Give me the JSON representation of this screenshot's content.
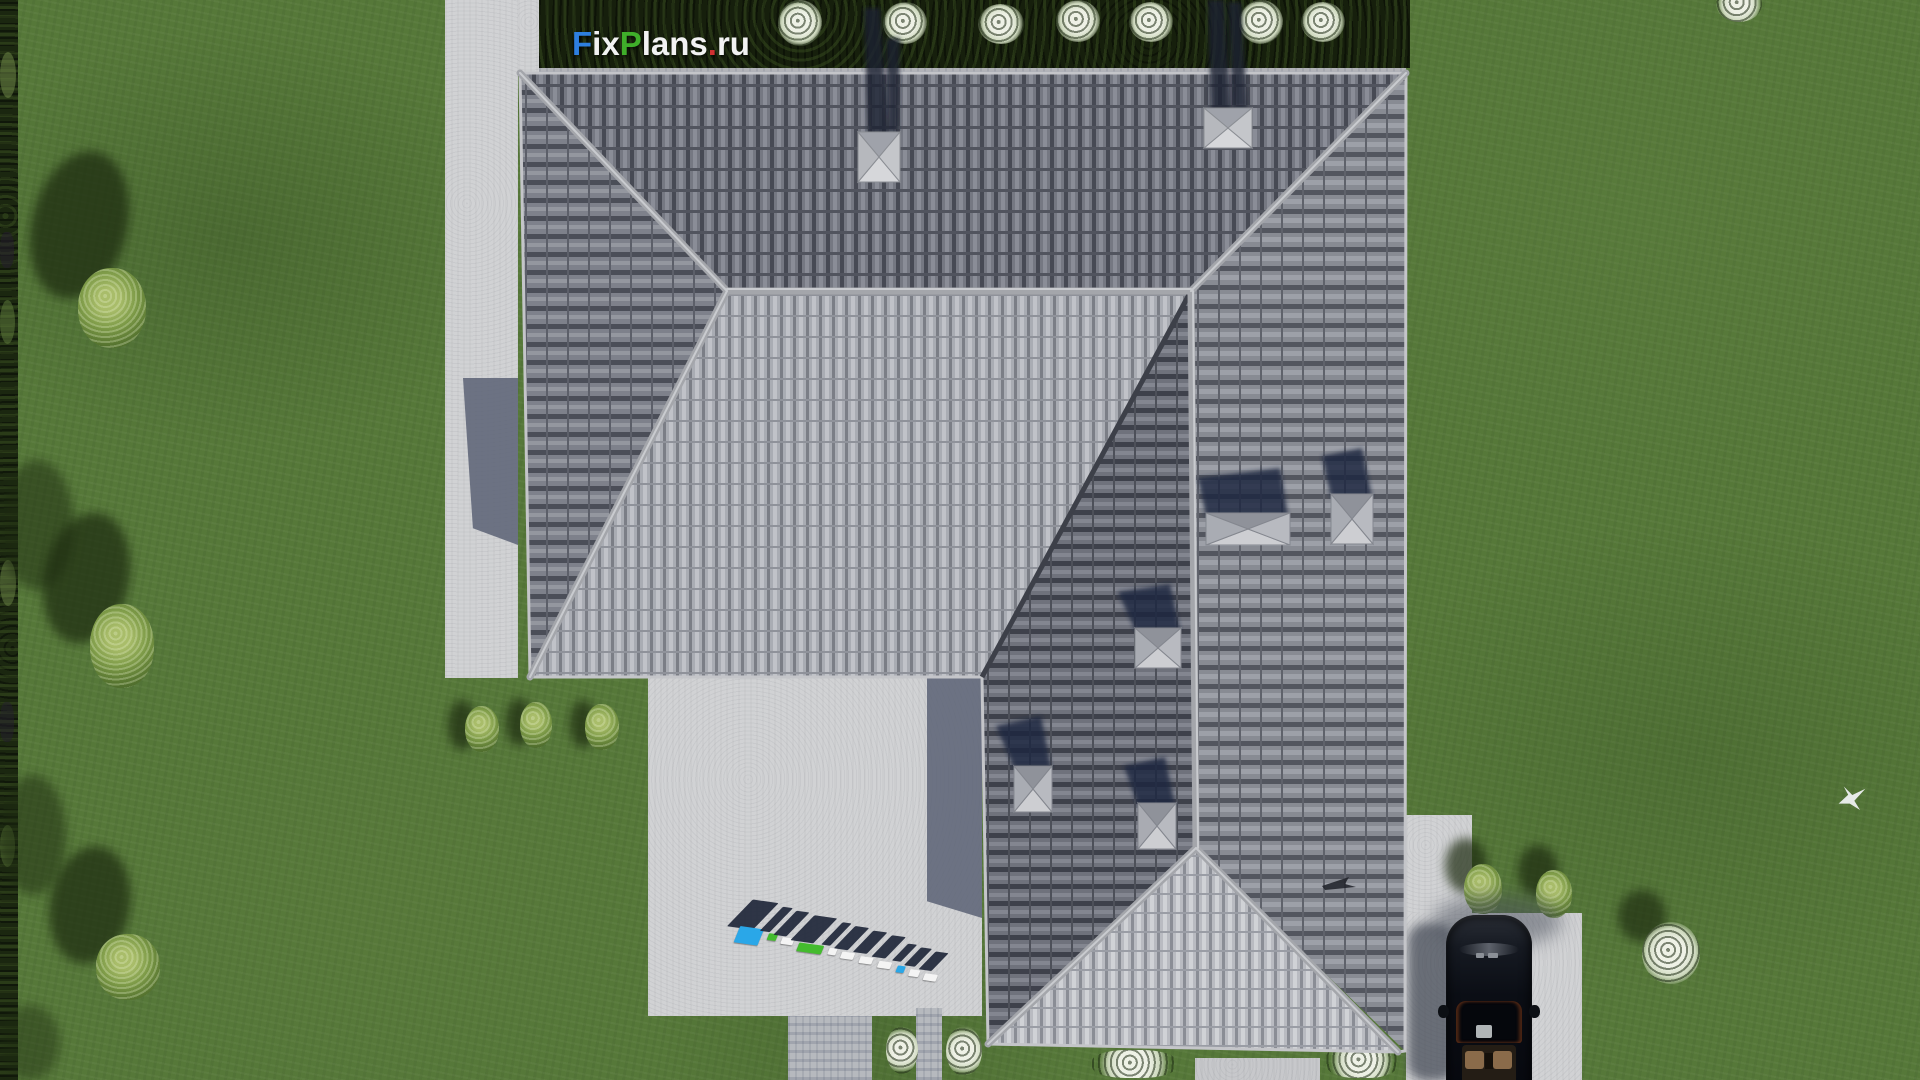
{
  "watermark": {
    "text": "FixPlans.ru",
    "segments": [
      {
        "text": "F",
        "color": "#2e7fe0"
      },
      {
        "text": "ix",
        "color": "#f2f2f2"
      },
      {
        "text": "P",
        "color": "#3fae2a"
      },
      {
        "text": "lans",
        "color": "#f2f2f2"
      },
      {
        "text": ".",
        "color": "#d03131"
      },
      {
        "text": "ru",
        "color": "#f2f2f2"
      }
    ]
  },
  "ground_logo": {
    "text": "FixPlans.ru",
    "style": "3d standing letters casting shadow on patio",
    "colors": {
      "blue": "#2aa7e8",
      "green": "#44bb2e",
      "white": "#f4f4f4",
      "shadow": "#20273a"
    }
  },
  "scene": {
    "type": "aerial top-down 3d architectural render of a house",
    "house": {
      "roof_type": "hip roof, L-shaped plan",
      "chimney_count": 2,
      "roof_vent_count": 5,
      "ridge_color": "#a4a6ab",
      "tile_sunlit_color": "#b9bbc1",
      "tile_shaded_color": "#73767f"
    },
    "car": {
      "body_color": "#0d1118",
      "interior_color": "#8a6b4a",
      "location": "driveway, bottom right"
    },
    "ground": {
      "lawn_color": "#567839",
      "paving_color": "#d1d2d4",
      "hedge_color": "#1b2710",
      "cast_shadow_color": "#20273a"
    },
    "vegetation": {
      "green_bushes": 8,
      "white_flower_bushes": 12
    },
    "bird_color": "#eef0f2"
  }
}
